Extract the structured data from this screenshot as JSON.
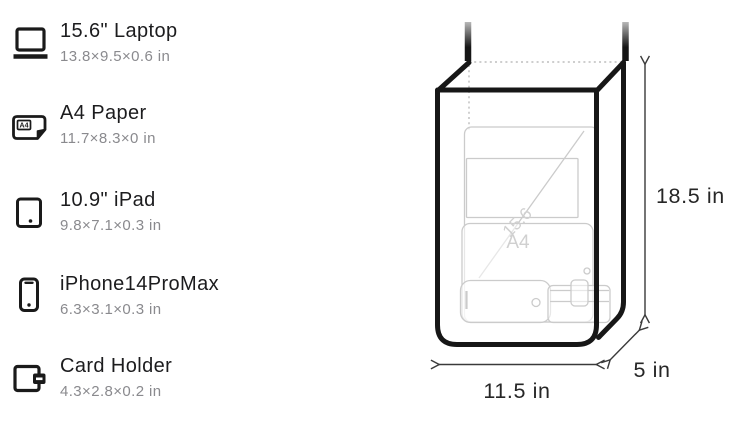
{
  "sidebar": {
    "items": [
      {
        "label": "15.6\" Laptop",
        "dims": "13.8×9.5×0.6 in",
        "icon": "laptop-icon"
      },
      {
        "label": "A4 Paper",
        "dims": "11.7×8.3×0 in",
        "icon": "a4-paper-icon",
        "icon_label": "A4"
      },
      {
        "label": "10.9\" iPad",
        "dims": "9.8×7.1×0.3 in",
        "icon": "ipad-icon"
      },
      {
        "label": "iPhone14ProMax",
        "dims": "6.3×3.1×0.3 in",
        "icon": "iphone-icon"
      },
      {
        "label": "Card Holder",
        "dims": "4.3×2.8×0.2 in",
        "icon": "card-holder-icon"
      }
    ]
  },
  "diagram": {
    "dimensions": {
      "height": "18.5 in",
      "width": "11.5 in",
      "depth": "5 in"
    },
    "ghost_items": {
      "laptop_label": "15.6",
      "paper_label": "A4"
    },
    "colors": {
      "bag_outline": "#171717",
      "ghost_outline": "#cbcbcb",
      "dimension_line": "#3a3a3a",
      "hidden_edge_dotted": "#bdbdbd",
      "label_text": "#262626"
    }
  }
}
